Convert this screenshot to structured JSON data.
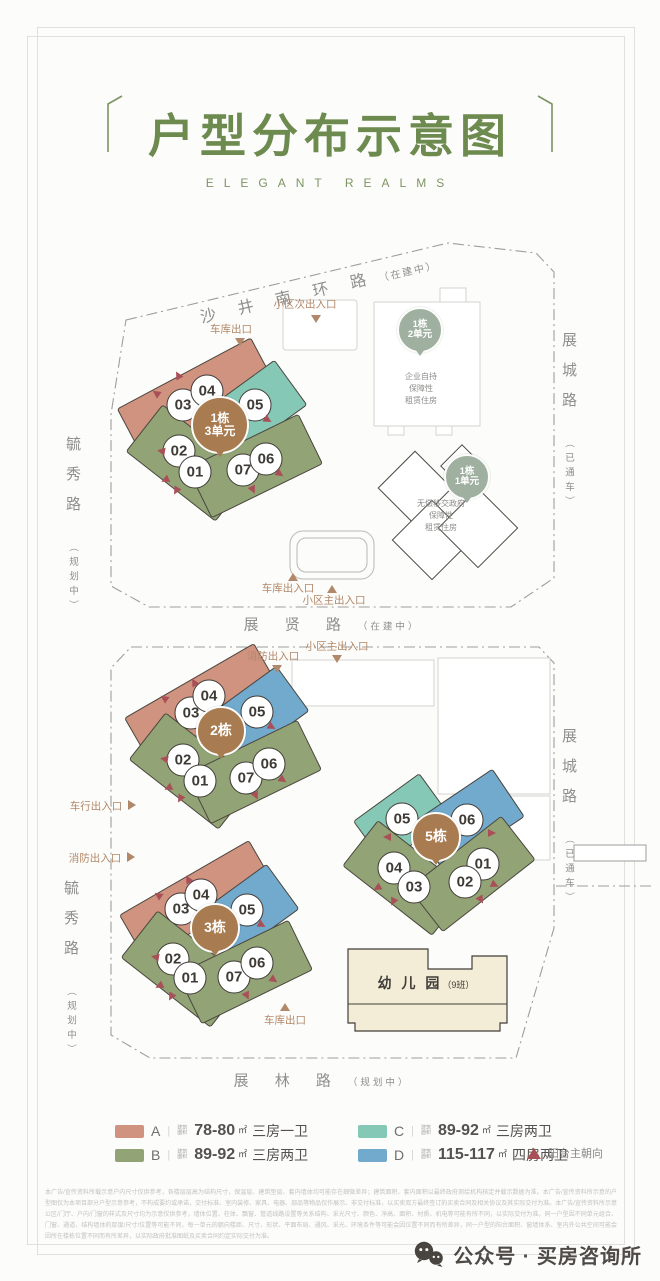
{
  "header": {
    "title": "户型分布示意图",
    "subtitle": "ELEGANT REALMS"
  },
  "roads": {
    "shajing": {
      "name": "沙 井 南 环 路",
      "status": "（在建中）"
    },
    "zhancheng": {
      "name": "展城路",
      "status": "（已通车）"
    },
    "yuxiu": {
      "name": "毓秀路",
      "status": "（规划中）"
    },
    "zhanxian": {
      "name": "展 贤 路",
      "status": "（在建中）"
    },
    "zhanlin": {
      "name": "展 林 路",
      "status": "（规划中）"
    }
  },
  "map1": {
    "entrances": {
      "side": "小区次出入口",
      "garage_exit": "车库出口",
      "garage": "车库出入口",
      "main": "小区主出入口"
    },
    "cluster": {
      "label1": "1栋",
      "label2": "3单元",
      "units": [
        "03",
        "04",
        "05",
        "02",
        "01",
        "07",
        "06"
      ]
    },
    "tower2": {
      "label1": "1栋",
      "label2": "2单元",
      "note1": "企业自持",
      "note2": "保障性",
      "note3": "租赁住房"
    },
    "tower1": {
      "label1": "1栋",
      "label2": "1单元",
      "note1": "无偿移交政府",
      "note2": "保障性",
      "note3": "租赁住房"
    }
  },
  "map2": {
    "entrances": {
      "main": "小区主出入口",
      "fire_top": "消防出入口",
      "vehicle": "车行出入口",
      "fire_left": "消防出入口",
      "garage_exit": "车库出口"
    },
    "cluster2": {
      "label": "2栋",
      "units": [
        "03",
        "04",
        "05",
        "02",
        "01",
        "07",
        "06"
      ]
    },
    "cluster5": {
      "label": "5栋",
      "units": [
        "05",
        "06",
        "04",
        "03",
        "01",
        "02"
      ]
    },
    "cluster3": {
      "label": "3栋",
      "units": [
        "03",
        "04",
        "05",
        "02",
        "01",
        "07",
        "06"
      ]
    },
    "kindergarten": {
      "name": "幼 儿 园",
      "classes": "（9班）"
    }
  },
  "legend": {
    "area_label1": "建筑",
    "area_label2": "面积",
    "items": [
      {
        "key": "A",
        "color": "#d09380",
        "value": "78-80",
        "unit": "㎡",
        "desc": "三房一卫"
      },
      {
        "key": "B",
        "color": "#92a475",
        "value": "89-92",
        "unit": "㎡",
        "desc": "三房两卫"
      },
      {
        "key": "C",
        "color": "#85c8b5",
        "value": "89-92",
        "unit": "㎡",
        "desc": "三房两卫"
      },
      {
        "key": "D",
        "color": "#72aace",
        "value": "115-117",
        "unit": "㎡",
        "desc": "四房两卫"
      }
    ],
    "marker": {
      "label": "阳台主朝向",
      "color": "#a94f58"
    }
  },
  "disclaimer": "本广告/宣传资料所载示意户内尺寸仅供参考，各楼层层高为结构尺寸，保温层、建筑垫层、套内墙体均可能存在细微差异；建筑面积、套内面积以最终政府测绘机构核定并载示数据为准。本广告/宣传资料所示意的户型图仅为本项目部分户型示意参考，不构成要约或承诺，交付标准、室内装修、家具、电器、部品等物品仅作展示、非交付标准，以买卖双方最终签订的买卖合同及相关协议及其实际交付为准。本广告/宣传资料所示意公区/门厅、户内/门窗的样式及尺寸均为示意仅供参考，墙体位置、柱体、飘窗、管道线路设置等关系结构、采光尺寸、颜色、净高、面积、材质、机电等可能有所不同，以实际交付为准。同一户型因不同单元组合、门窗、通道、结构墙体的厚度/尺寸/位置等可能不同，每一单元的朝向楼距、尺寸、形状、平面布局、通风、采光、环境条件等可能会因位置不同而有所差异，同一户型的阳台面积、窗墙体系、室内外公共空间可能会因所在楼栋位置不同而有所差异，以实际政府批准图纸及买卖合同约定实际交付为准。",
  "brand": {
    "label": "公众号 · 买房咨询所"
  }
}
